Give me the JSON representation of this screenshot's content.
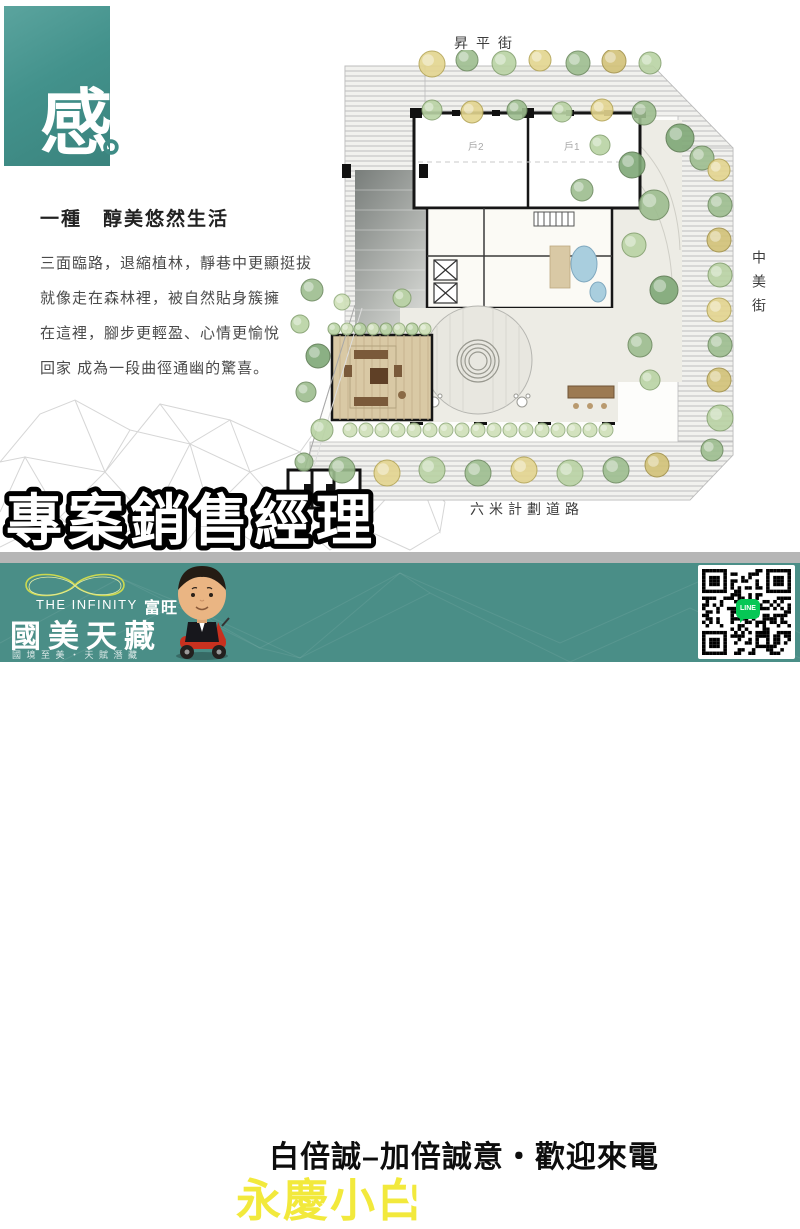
{
  "hero": {
    "glyph": "感",
    "period": "。"
  },
  "intro": {
    "heading": "一種　醇美悠然生活",
    "lines": [
      "三面臨路，退縮植林，靜巷中更顯挺拔",
      "就像走在森林裡，被自然貼身簇擁",
      "在這裡，腳步更輕盈、心情更愉悅",
      "回家 成為一段曲徑通幽的驚喜。"
    ]
  },
  "plan": {
    "street_top": "昇平街",
    "street_right": "中美街",
    "street_bottom": "六米計劃道路",
    "unit_label_1": "戶1",
    "unit_label_2": "戶2"
  },
  "overlay": {
    "title": "專案銷售經理"
  },
  "banner": {
    "brand_en": "THE INFINITY",
    "brand_zh": "富旺",
    "brand_name": "國美天藏",
    "brand_tagline": "國境至美・天賦潛藏",
    "slogan": "白倍誠–加倍誠意・歡迎來電",
    "agent_name": "永慶小白",
    "phone": "0987-212312",
    "qr_line_label": "LINE"
  },
  "colors": {
    "hero_teal": "#3f8c86",
    "banner_teal": "#4a8e87",
    "accent_yellow": "#f2e93c",
    "line_green": "#06c755",
    "divider_gray": "#b6b6b6"
  }
}
